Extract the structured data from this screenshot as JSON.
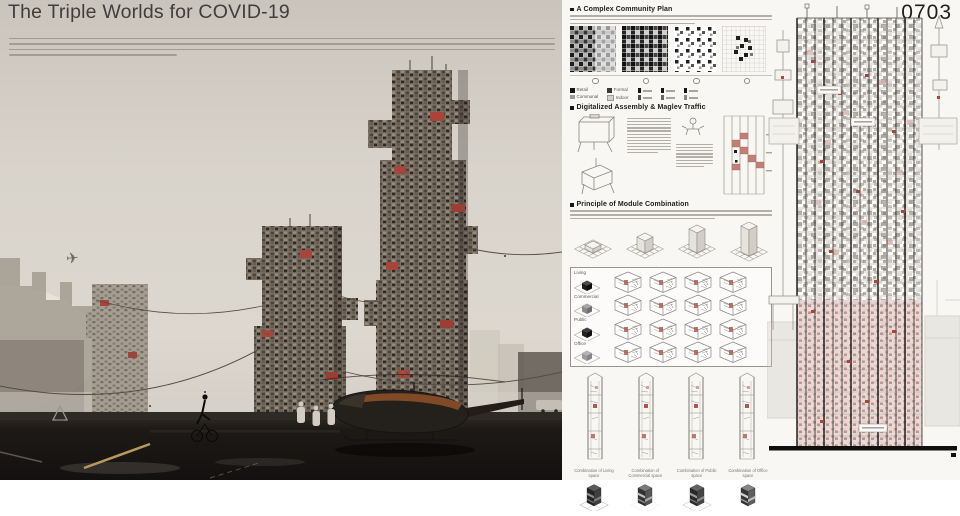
{
  "poster": {
    "title": "The Triple Worlds for COVID-19",
    "entry_number": "0703"
  },
  "icons": {
    "airplane": "✈"
  },
  "sections": {
    "community": {
      "heading": "A Complex Community Plan",
      "legend": [
        {
          "dark": "Retail",
          "light": "Communal"
        },
        {
          "dark": "Formal",
          "light": "Indoor"
        }
      ]
    },
    "assembly": {
      "heading": "Digitalized Assembly & Maglev Traffic"
    },
    "module": {
      "heading": "Principle of Module Combination",
      "rows": [
        {
          "label": "Living"
        },
        {
          "label": "Commercial"
        },
        {
          "label": "Public"
        },
        {
          "label": "Office"
        }
      ]
    },
    "combinations": {
      "captions": [
        "Combination of Living space",
        "Combination of Commercial space",
        "Combination of Public space",
        "Combination of Office space"
      ]
    }
  },
  "colors": {
    "accent_red": "#a8443a",
    "module_pink": "#d9b3ad",
    "board_bg": "#f8f7f4",
    "sky": "#d8d3cb",
    "ground": "#17130f",
    "title_text": "#403f3d"
  }
}
